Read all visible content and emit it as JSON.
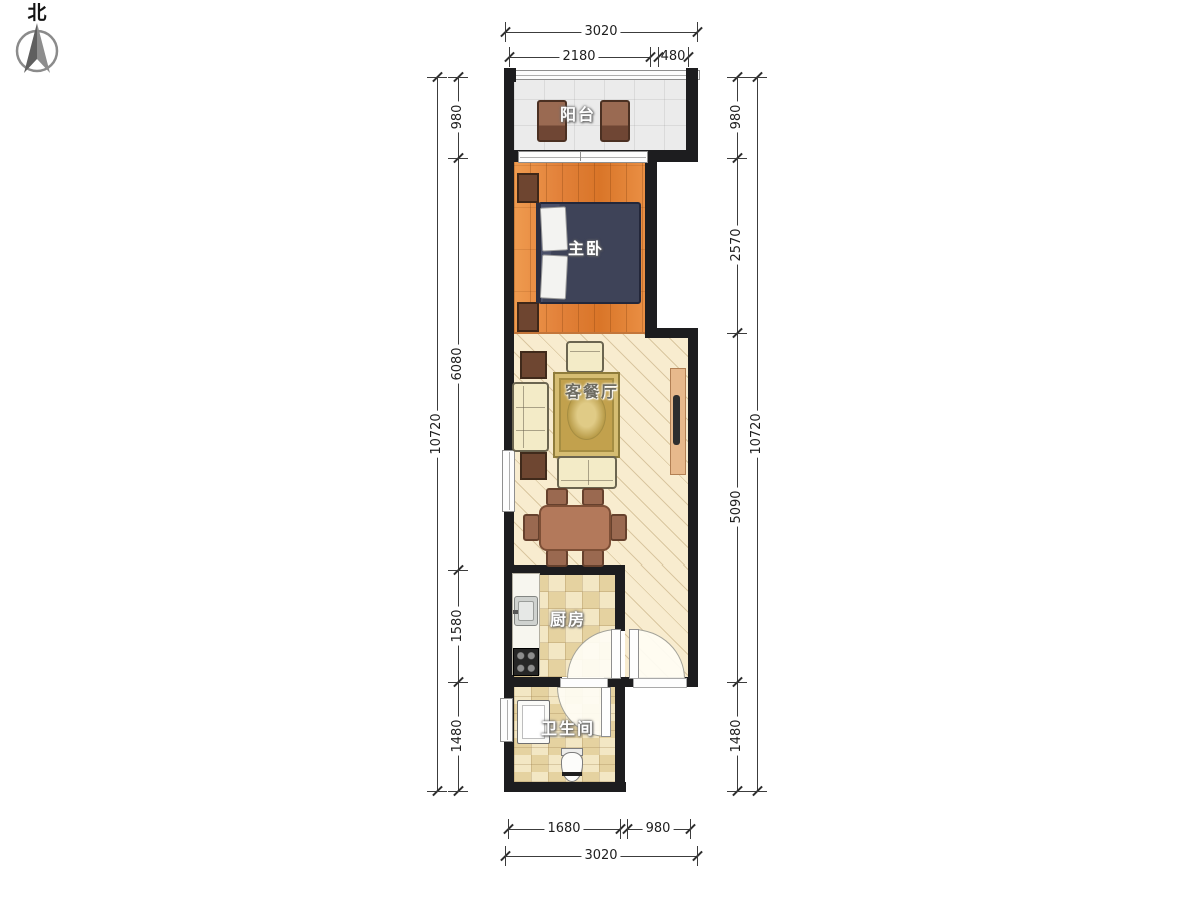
{
  "compass": {
    "label": "北"
  },
  "rooms": {
    "balcony": {
      "label": "阳台"
    },
    "master_bedroom": {
      "label": "主卧"
    },
    "living_dining": {
      "label": "客餐厅"
    },
    "kitchen": {
      "label": "厨房"
    },
    "bathroom": {
      "label": "卫生间"
    }
  },
  "dimensions": {
    "top": {
      "total": "3020",
      "bedroom_width": "2180",
      "step_width": "480"
    },
    "bottom": {
      "bath_width": "1680",
      "entry_width": "980",
      "total": "3020"
    },
    "left": {
      "balcony": "980",
      "bedroom_living": "6080",
      "kitchen": "1580",
      "bathroom": "1480",
      "total": "10720"
    },
    "right": {
      "balcony": "980",
      "bedroom": "2570",
      "living": "5090",
      "bathroom": "1480",
      "total": "10720"
    }
  },
  "colors": {
    "wall": "#1d1d1f",
    "bedroom_floor": "#e2813a",
    "living_floor": "#f8eccf",
    "tile_floor": "#f3e7c4",
    "balcony_floor": "#ebebeb",
    "bed": "#3e4358",
    "rug": "#c2a14d",
    "wood_furniture": "#6e4530",
    "sofa": "#f3ebc7",
    "dining_table": "#b3795b",
    "label_text": "#ffffff",
    "dimension_text": "#1e1e1e"
  }
}
